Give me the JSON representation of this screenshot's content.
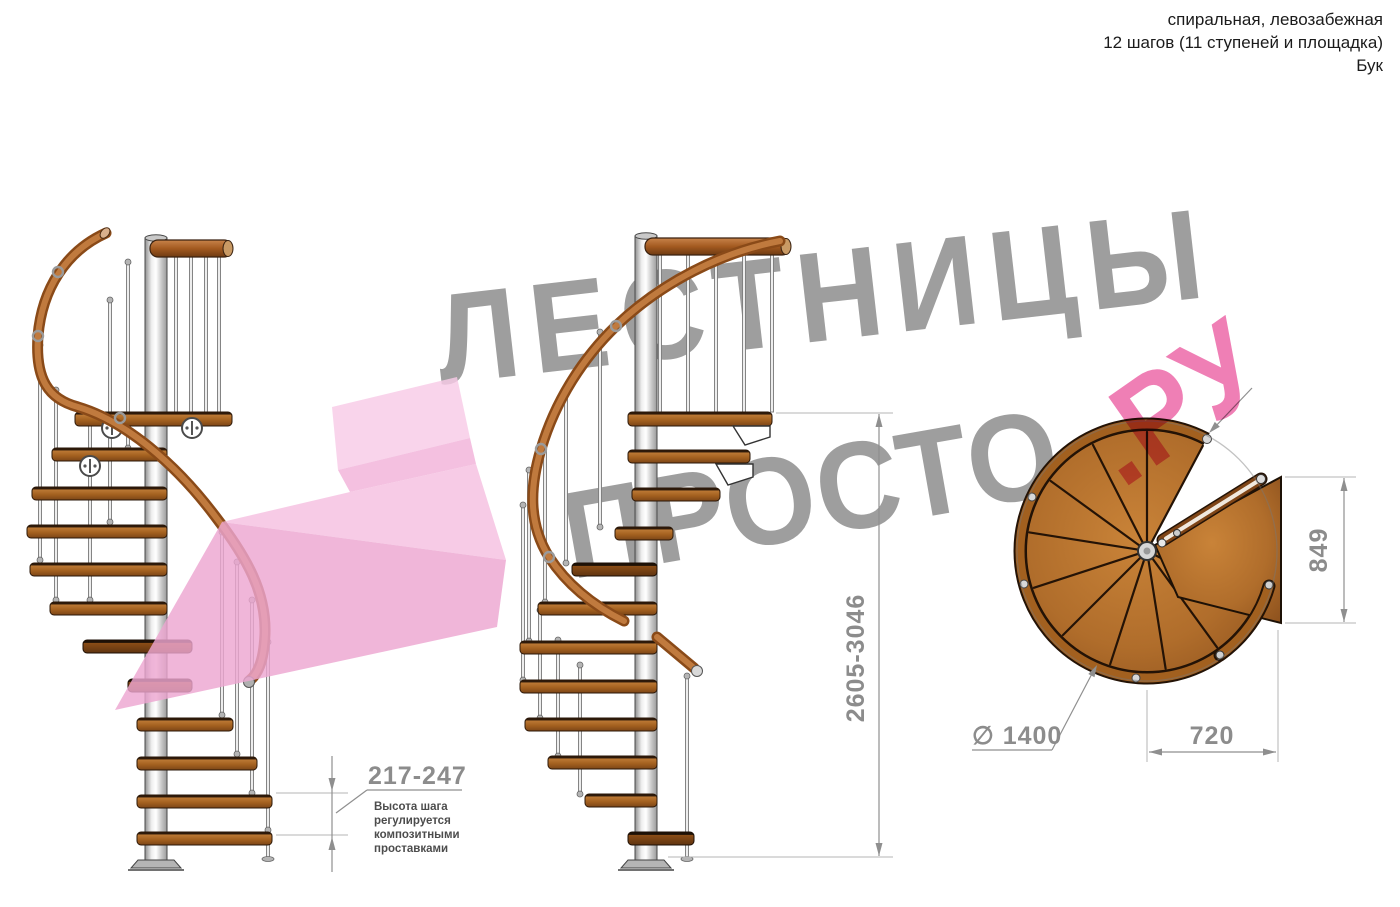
{
  "header": {
    "line1": "спиральная, левозабежная",
    "line2": "12 шагов (11 ступеней и площадка)",
    "line3": "Бук"
  },
  "watermark": {
    "word1": "ЛЕСТНИЦЫ",
    "word2": "ПРОСТО",
    "word3": ".РУ",
    "gray_color": "#9e9e9e",
    "pink_color": "#ef7fb5"
  },
  "dimensions": {
    "step_height": "217-247",
    "step_height_note_lines": [
      "Высота шага",
      "регулируется",
      "композитными",
      "проставками"
    ],
    "total_height": "2605-3046",
    "platform_width": "849",
    "platform_depth": "720",
    "diameter": "∅ 1400"
  },
  "colors": {
    "wood": "#b06e2d",
    "handrail": "#a35a20",
    "pole": "#d9d9d9",
    "dimension_text": "#8c8c8c",
    "note_text": "#4c4c4c",
    "pink_arrow": "#f4bade"
  }
}
